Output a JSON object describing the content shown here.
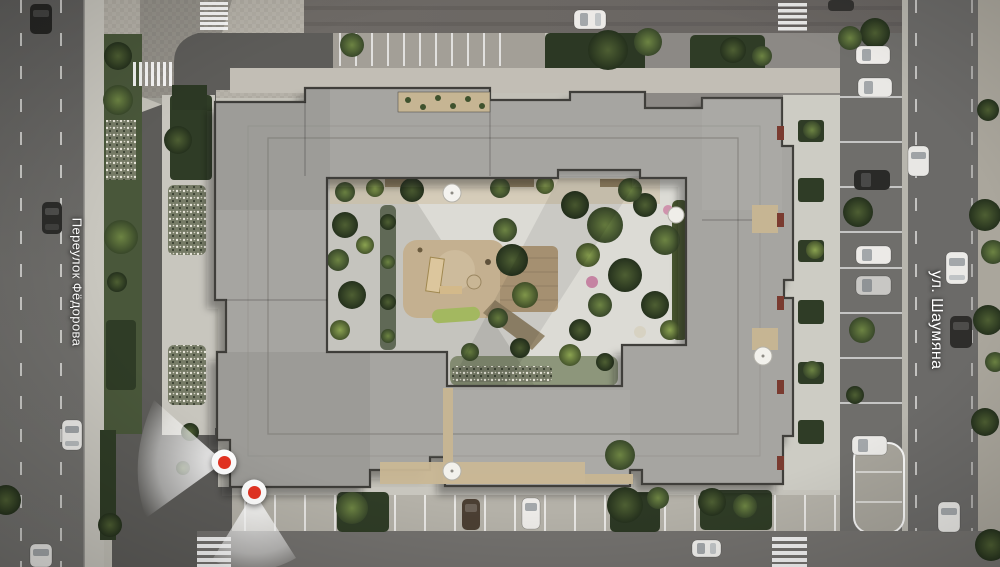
{
  "streets": {
    "left": {
      "name": "Переулок Фёдорова"
    },
    "right": {
      "name": "ул. Шаумяна"
    }
  },
  "viewpoints": [
    {
      "name": "viewpoint-marker-1",
      "shape": "red-dot-with-view-cone",
      "cone_direction": "west"
    },
    {
      "name": "viewpoint-marker-2",
      "shape": "red-dot-with-view-cone",
      "cone_direction": "south"
    }
  ],
  "colors": {
    "marker_red": "#e53322",
    "marker_ring": "#ffffff",
    "cone_white": "#ffffff",
    "roof_gray": "#a6a5a1",
    "parapet_dark": "#403f3b",
    "road_gray": "#6b6a67",
    "courtyard_paving": "#dcdbd5",
    "greenery_dark": "#3d4b2a",
    "sand_tan": "#c4b090",
    "terrace_tan": "#c6b593"
  }
}
